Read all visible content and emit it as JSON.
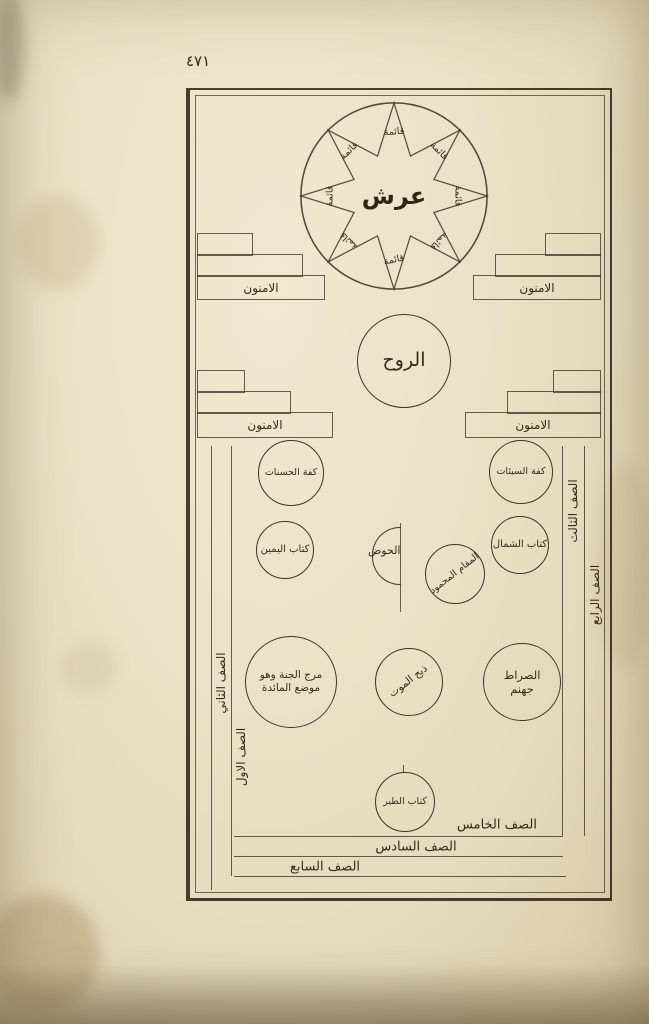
{
  "page": {
    "folio_number": "٤٧١"
  },
  "diagram": {
    "throne": {
      "label": "عرش",
      "pillar": "قائمة"
    },
    "spirit": {
      "label": "الروح"
    },
    "stair_label": "الامنون",
    "scale_good": "كفة الحسنات",
    "scale_bad": "كفة السيئات",
    "book_right": "كتاب اليمين",
    "basin": "الحوض",
    "praised_station": "المقام المحمود",
    "book_left": "كتاب الشمال",
    "meadow_line1": "مرج الجنة وهو",
    "meadow_line2": "موضع المائدة",
    "death_slaughter": "ذبح الموت",
    "bridge_line1": "الصراط",
    "bridge_line2": "جهنم",
    "book_bird": "كتاب الطير",
    "rows": {
      "first": "الصف الاول",
      "second": "الصف الثاني",
      "third": "الصف الثالث",
      "fourth": "الصف الرابع",
      "fifth": "الصف الخامس",
      "sixth": "الصف السادس",
      "seventh": "الصف السابع"
    }
  }
}
